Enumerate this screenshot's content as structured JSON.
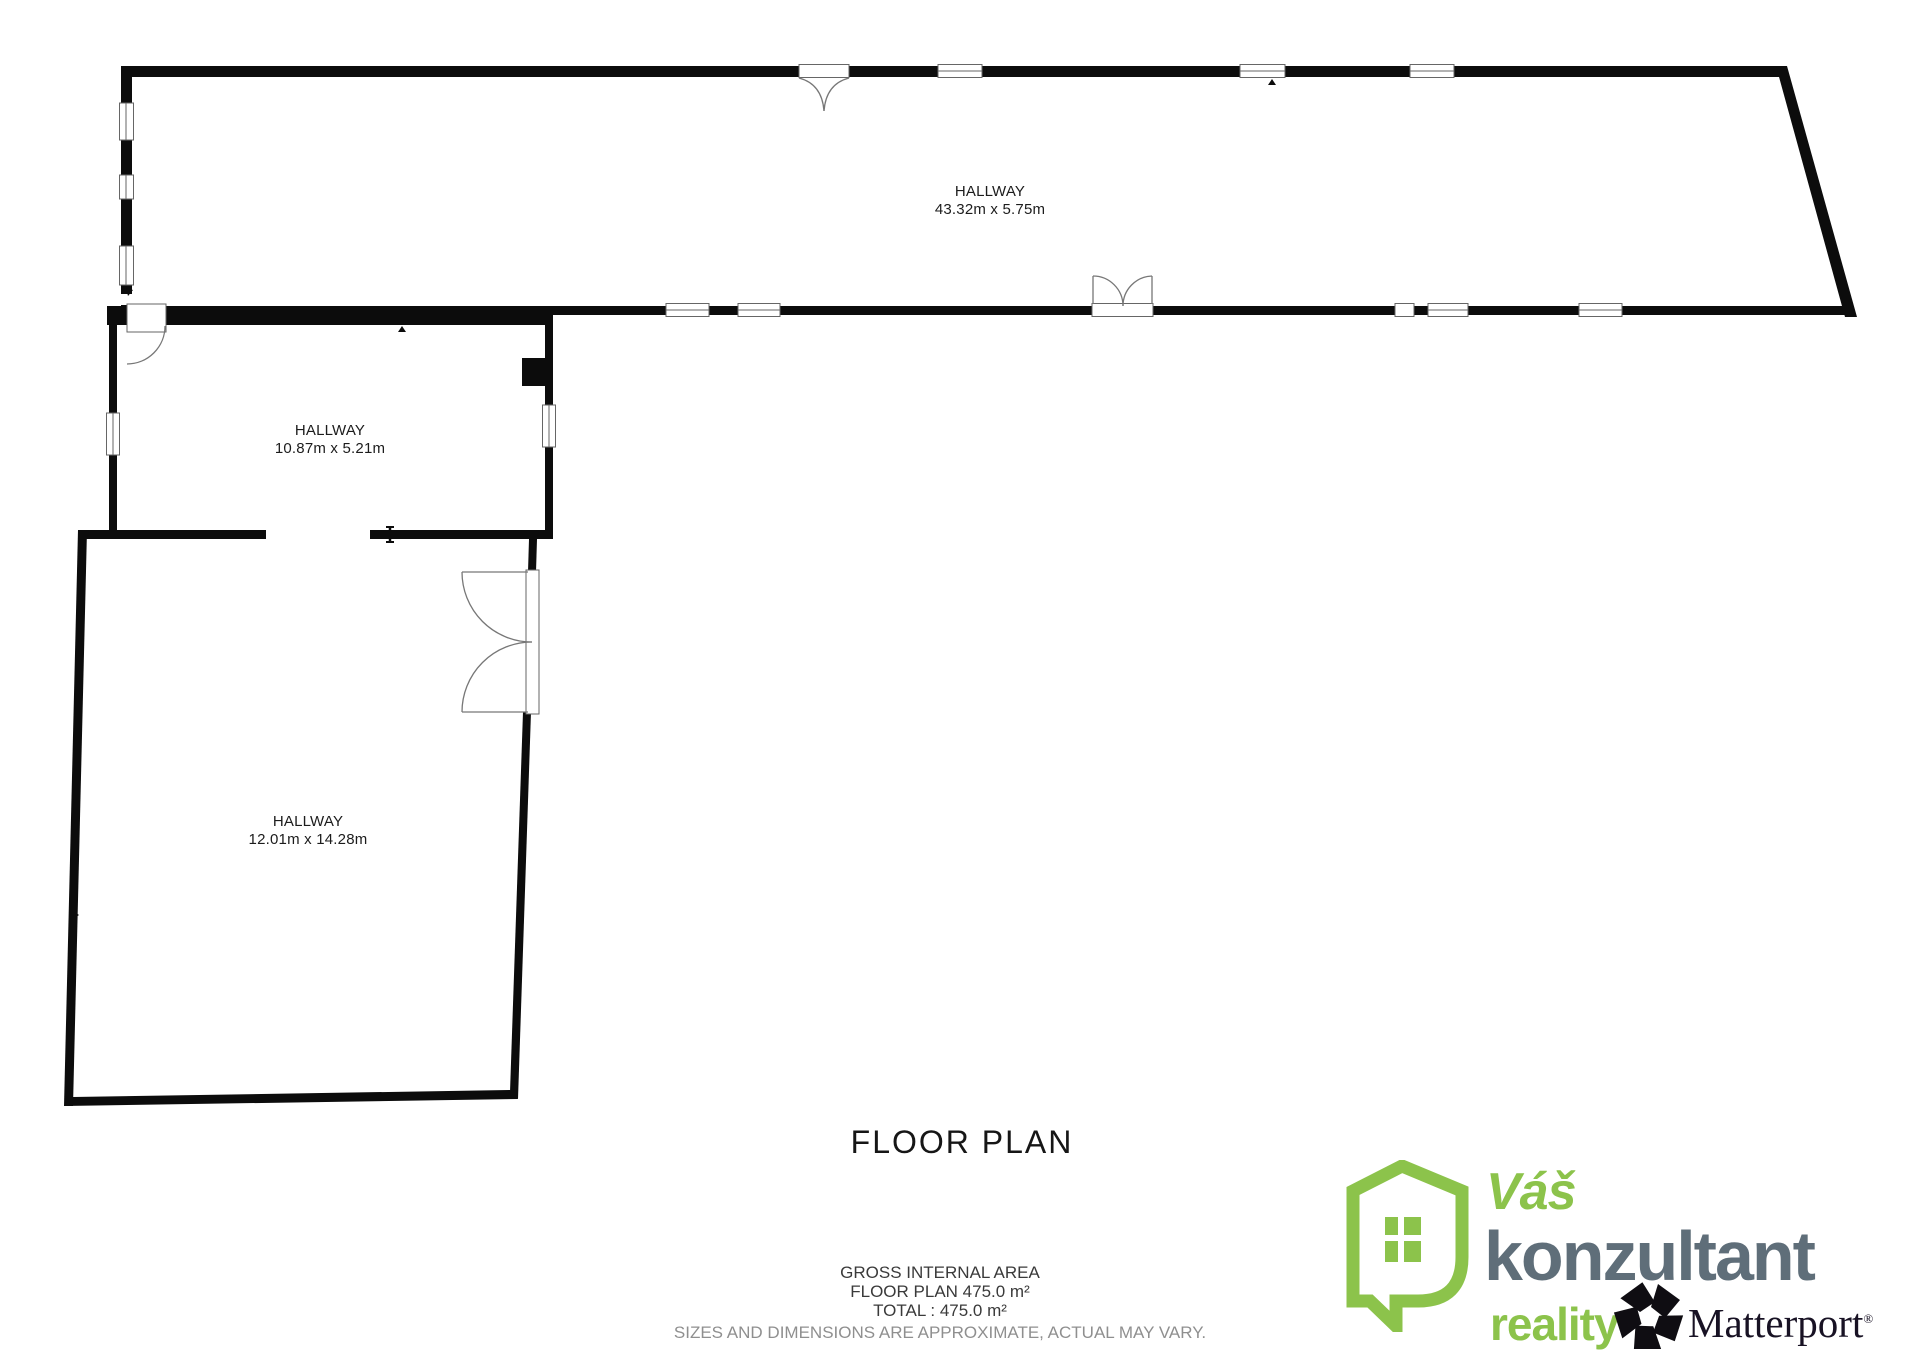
{
  "floor_plan": {
    "title": "FLOOR PLAN",
    "rooms": [
      {
        "name": "HALLWAY",
        "dimensions": "43.32m x 5.75m"
      },
      {
        "name": "HALLWAY",
        "dimensions": "10.87m x 5.21m"
      },
      {
        "name": "HALLWAY",
        "dimensions": "12.01m x 14.28m"
      }
    ],
    "summary": {
      "gross_internal_area_label": "GROSS INTERNAL AREA",
      "floor_plan_area": "FLOOR PLAN 475.0 m²",
      "total_area": "TOTAL :  475.0 m²",
      "disclaimer": "SIZES AND DIMENSIONS ARE APPROXIMATE, ACTUAL MAY VARY."
    }
  },
  "branding": {
    "vas": "Váš",
    "konzultant": "konzultant",
    "reality": "reality",
    "matterport": "Matterport",
    "registered": "®",
    "colors": {
      "green": "#8CC34B",
      "slate": "#5F6E79",
      "matterport_dark": "#181224",
      "wall_black": "#0c0c0c"
    }
  }
}
